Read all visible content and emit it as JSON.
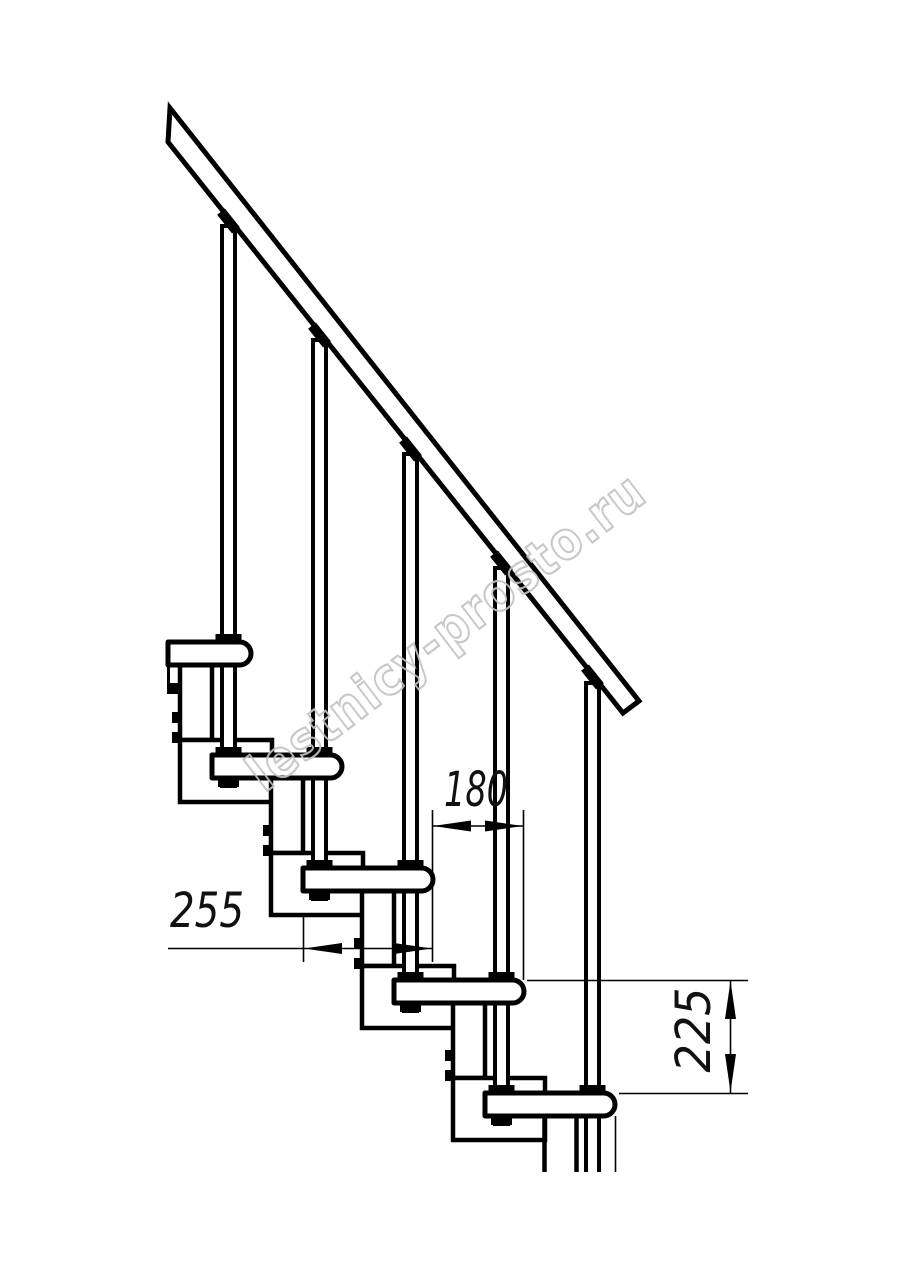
{
  "drawing": {
    "kind": "modular staircase side elevation",
    "dimensions": {
      "run": {
        "label": "180"
      },
      "tread_depth": {
        "label": "255"
      },
      "rise": {
        "label": "225"
      }
    },
    "watermark": {
      "text": "lestnicy-prosto.ru",
      "color": "#c3c3c3"
    },
    "structure": {
      "treads": 5,
      "posts": 5,
      "handrail": true
    },
    "colors": {
      "line": "#000000",
      "background": "#ffffff"
    }
  }
}
